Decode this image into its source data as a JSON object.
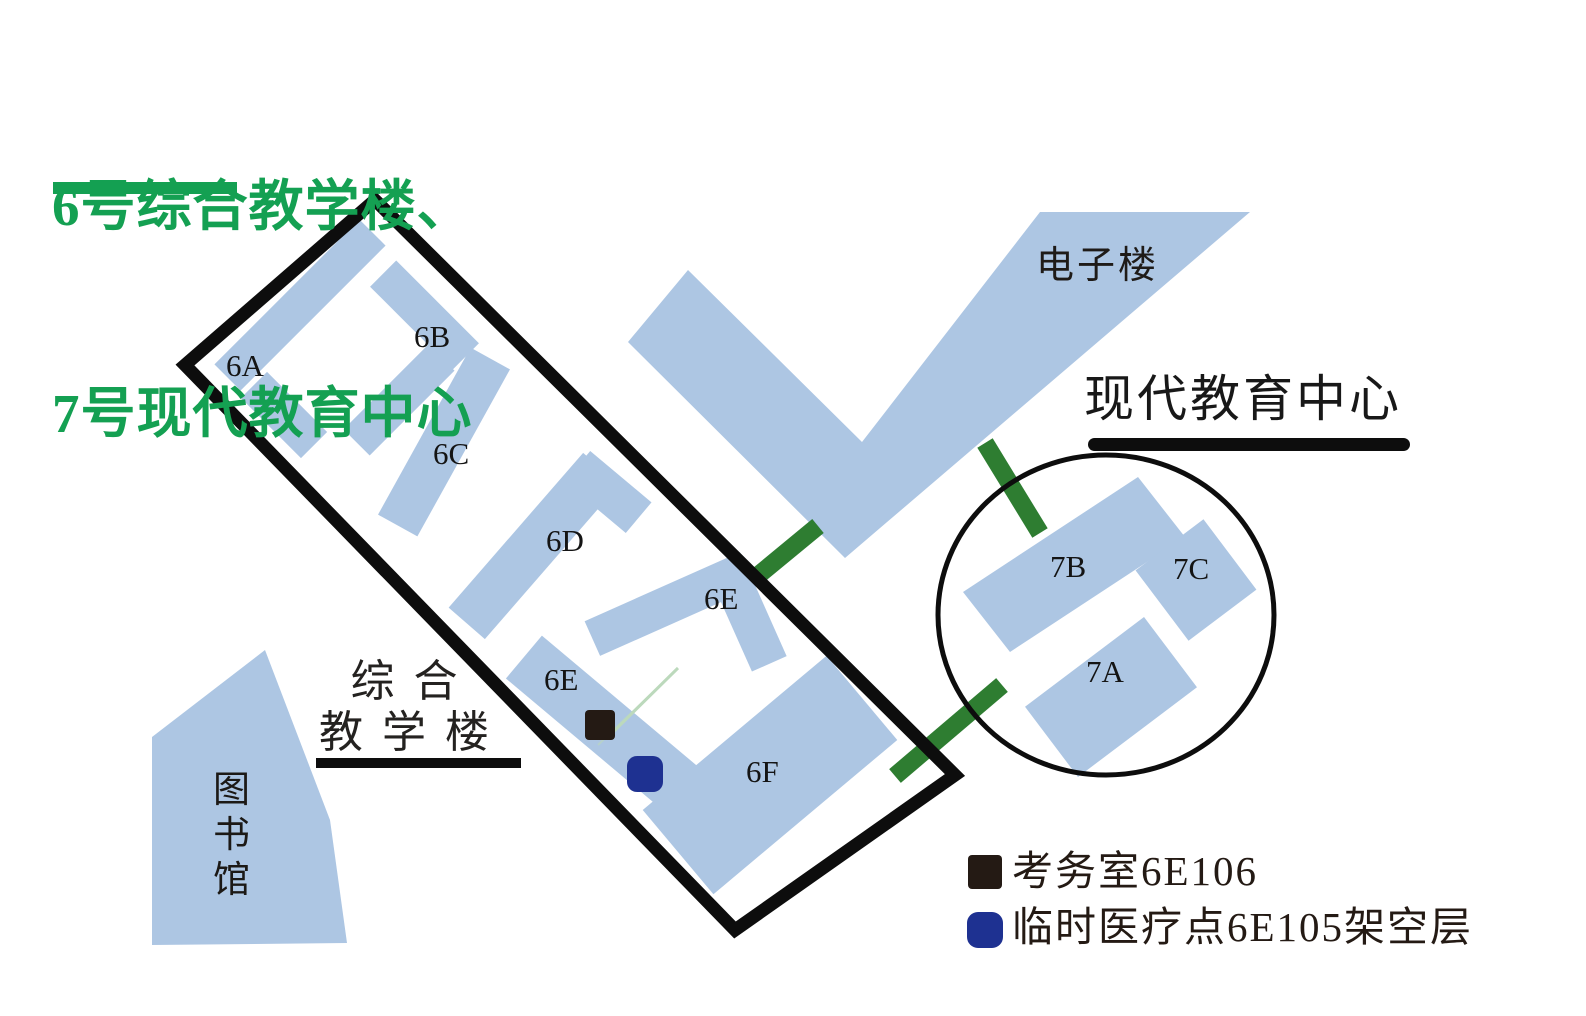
{
  "title": {
    "line1": "6号综合教学楼、",
    "line2": "7号现代教育中心",
    "color": "#14a052"
  },
  "map": {
    "building_fill": "#adc6e3",
    "outline_color": "#0d0d0d",
    "connector_color": "#2e7d31",
    "faint_path_color": "#bcd9bc",
    "labels": {
      "b6a": "6A",
      "b6b": "6B",
      "b6c": "6C",
      "b6d": "6D",
      "b6e": "6E",
      "b6f": "6F",
      "b7a": "7A",
      "b7b": "7B",
      "b7c": "7C"
    },
    "areas": {
      "electronics_building": "电子楼",
      "modern_education_center": "现代教育中心",
      "comprehensive_teaching_line1": "综 合",
      "comprehensive_teaching_line2": "教 学 楼",
      "library": "图书馆"
    }
  },
  "legend": {
    "items": [
      {
        "label": "考务室6E106",
        "color": "#241a14"
      },
      {
        "label": "临时医疗点6E105架空层",
        "color": "#1e3191"
      }
    ]
  }
}
